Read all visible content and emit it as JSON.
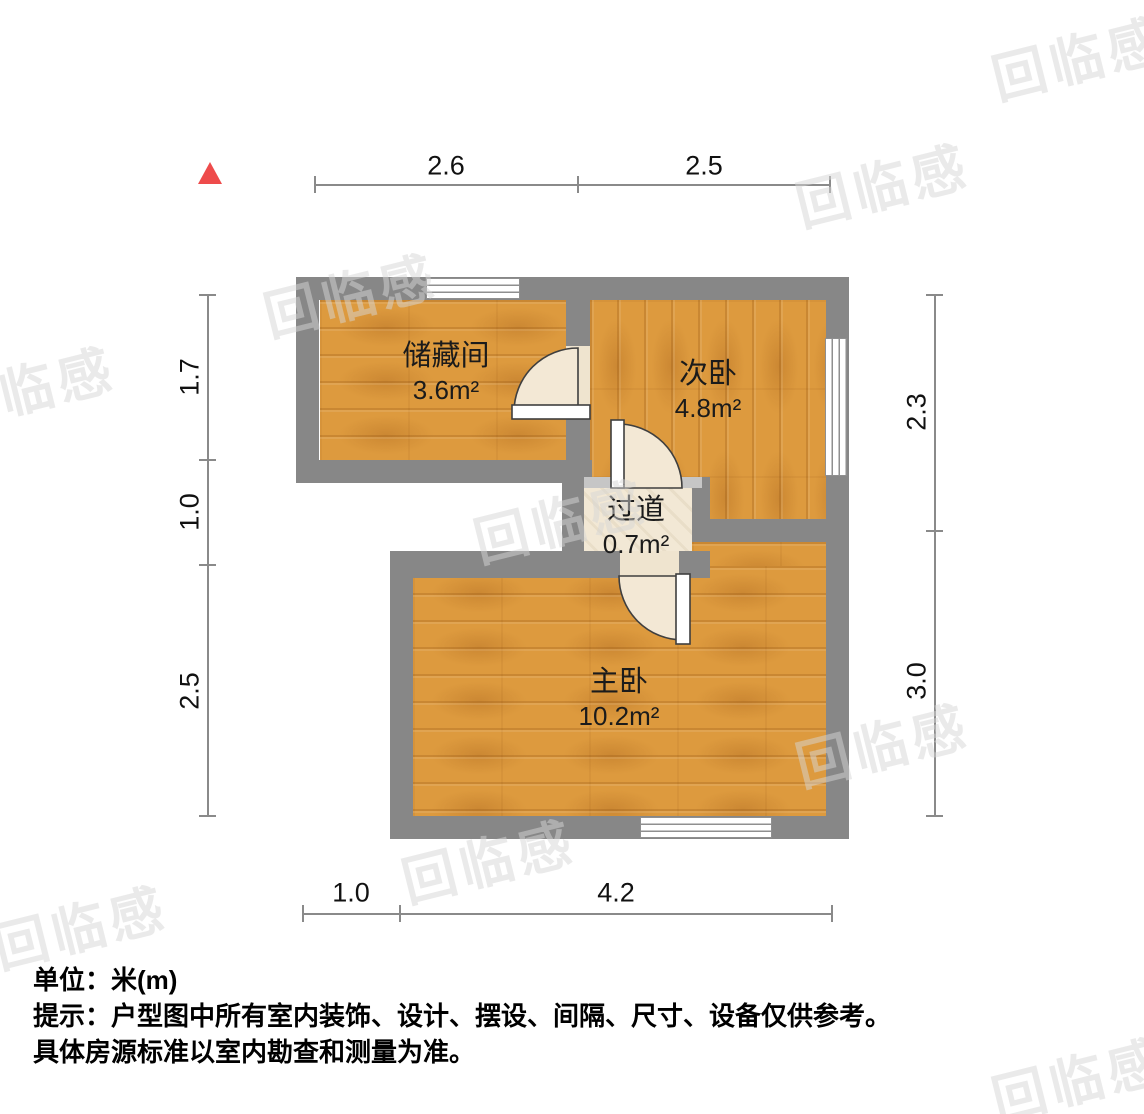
{
  "plan": {
    "title_hint": "residential floor plan",
    "rooms": [
      {
        "id": "storage",
        "name": "储藏间",
        "area": "3.6m²"
      },
      {
        "id": "secondary-bedroom",
        "name": "次卧",
        "area": "4.8m²"
      },
      {
        "id": "hallway",
        "name": "过道",
        "area": "0.7m²"
      },
      {
        "id": "master-bedroom",
        "name": "主卧",
        "area": "10.2m²"
      }
    ]
  },
  "dimensions": {
    "top": [
      "2.6",
      "2.5"
    ],
    "left": [
      "1.7",
      "1.0",
      "2.5"
    ],
    "right": [
      "2.3",
      "3.0"
    ],
    "bottom": [
      "1.0",
      "4.2"
    ]
  },
  "footer": {
    "unit_line": "单位：米(m)",
    "note_line1": "提示：户型图中所有室内装饰、设计、摆设、间隔、尺寸、设备仅供参考。",
    "note_line2": "具体房源标准以室内勘查和测量为准。"
  },
  "watermark": {
    "text": "回临感"
  },
  "colors": {
    "wall": "#878787",
    "wood_floor": "#dd9a3e",
    "hall_floor": "#f2e8d5",
    "door_swing": "#f3e8d5",
    "north_arrow": "#ee4b4b",
    "dimension_line": "#8a8a8a"
  }
}
